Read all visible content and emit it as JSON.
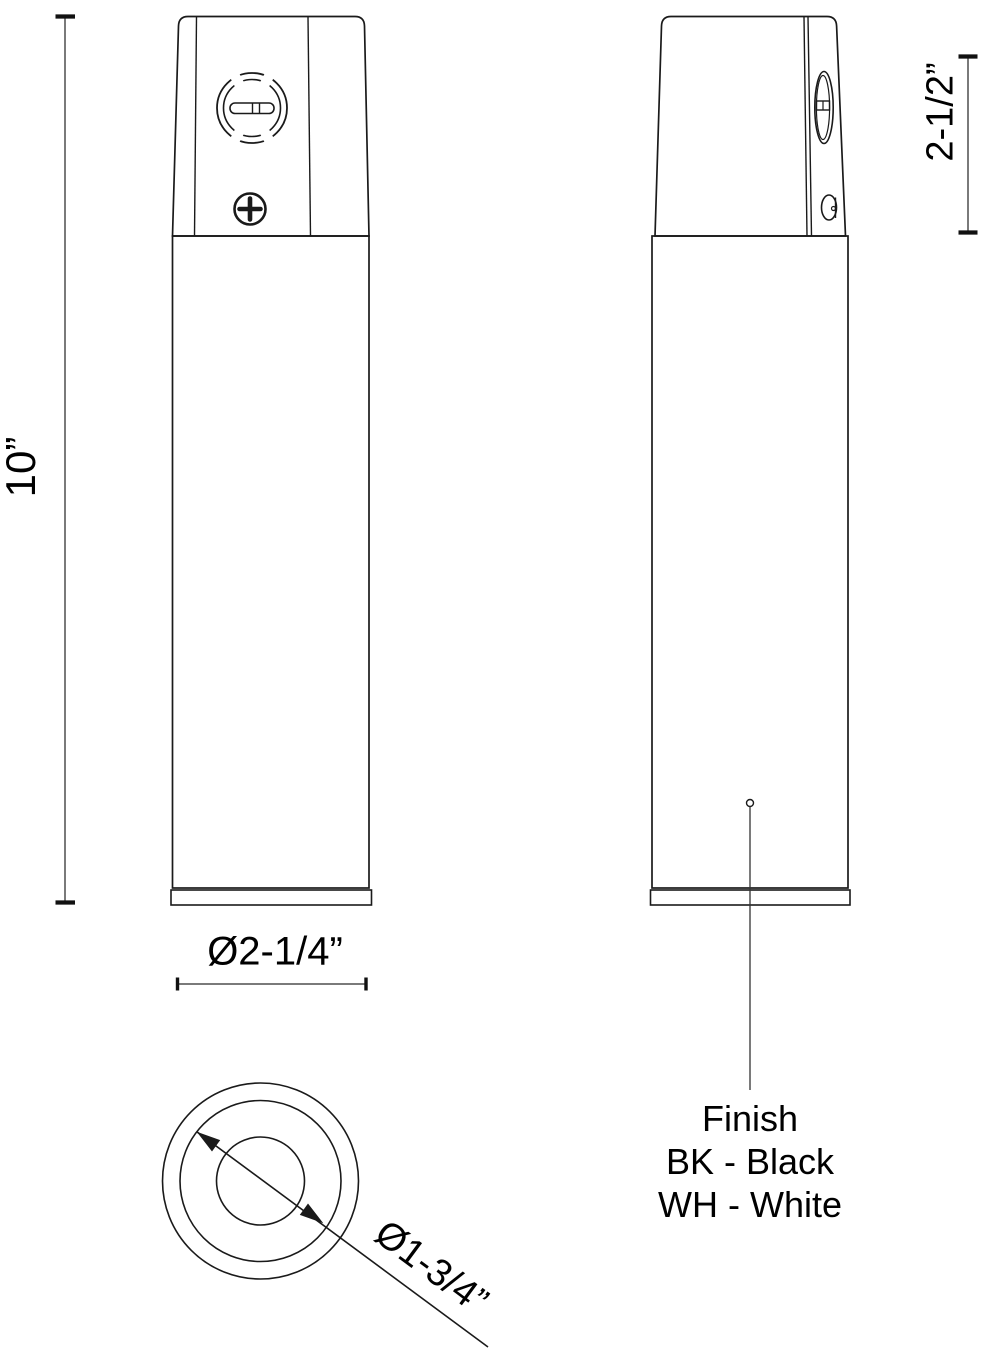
{
  "dimensions": {
    "overall_height": "10”",
    "cap_height": "2-1/2”",
    "outer_diameter": "Ø2-1/4”",
    "inner_diameter": "Ø1-3/4”"
  },
  "finish_legend": {
    "title": "Finish",
    "options": [
      "BK - Black",
      "WH - White"
    ]
  },
  "colors": {
    "background": "#ffffff",
    "outline": "#1a1a1a",
    "dimension_line": "#7a7a7a",
    "tick": "#111111",
    "text": "#000000"
  }
}
